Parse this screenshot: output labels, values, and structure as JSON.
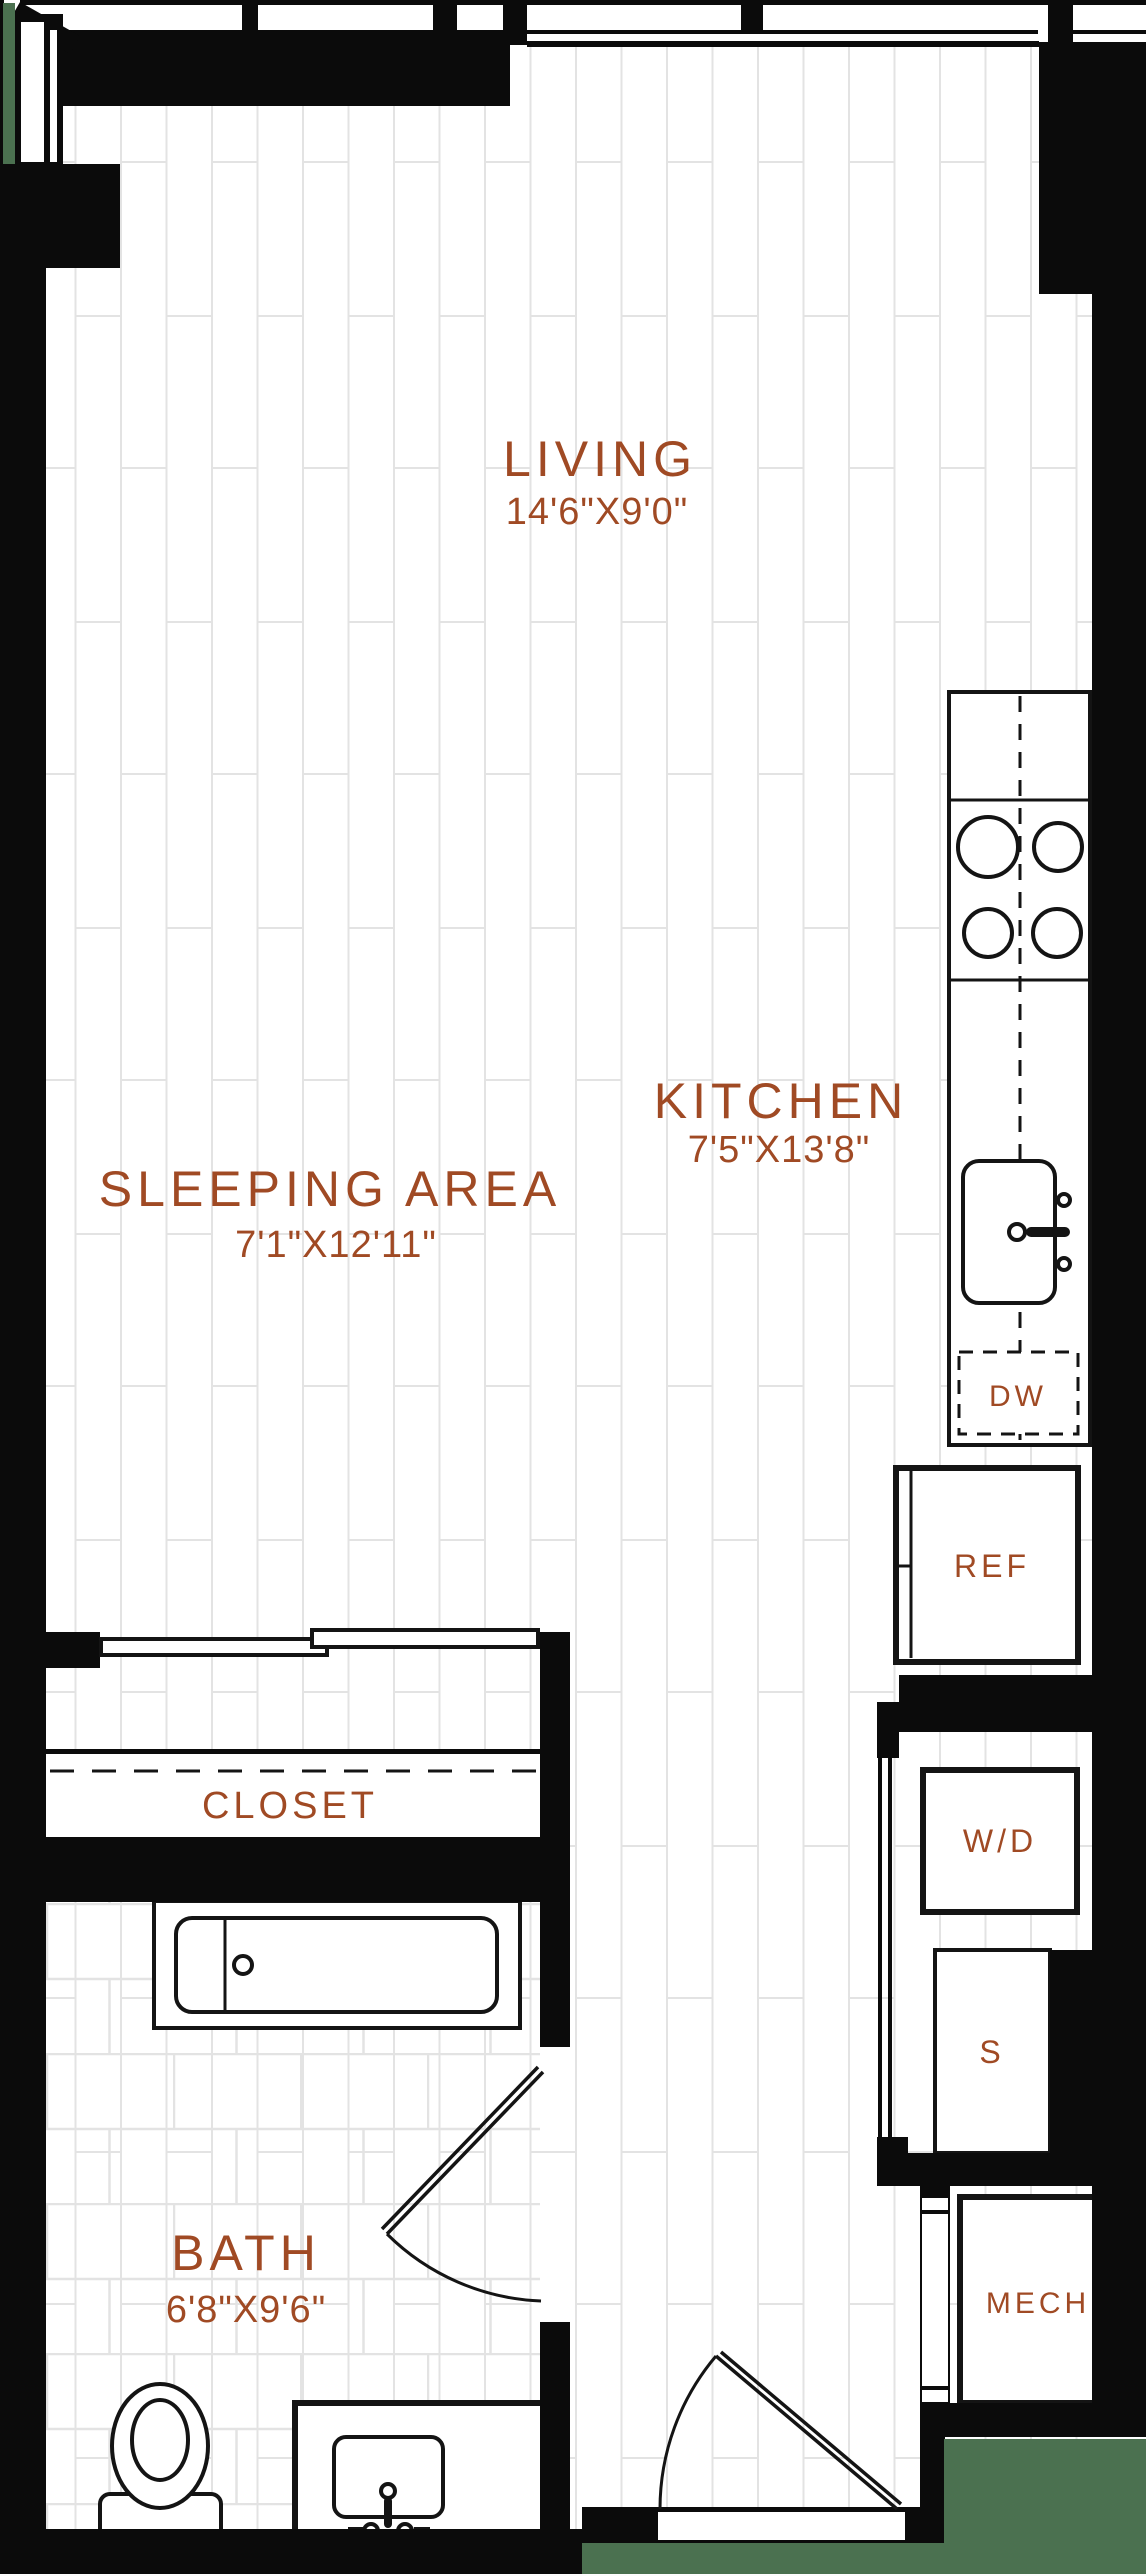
{
  "plan": {
    "rooms": {
      "living": {
        "name": "LIVING",
        "dims": "14'6\"X9'0\""
      },
      "kitchen": {
        "name": "KITCHEN",
        "dims": "7'5\"X13'8\""
      },
      "sleeping": {
        "name": "SLEEPING AREA",
        "dims": "7'1\"X12'11\""
      },
      "closet": {
        "name": "CLOSET"
      },
      "bath": {
        "name": "BATH",
        "dims": "6'8\"X9'6\""
      }
    },
    "appliances": {
      "dishwasher": {
        "label": "DW"
      },
      "refrigerator": {
        "label": "REF"
      },
      "washer_dryer": {
        "label": "W/D"
      },
      "shelves": {
        "label": "S"
      },
      "mechanical": {
        "label": "MECH"
      }
    }
  },
  "colors": {
    "label": "#A04A24",
    "wall": "#0B0B0B",
    "green": "#4B7150",
    "floorline": "#E3E3E3",
    "fixture": "#141414",
    "bg": "#FFFFFF"
  }
}
